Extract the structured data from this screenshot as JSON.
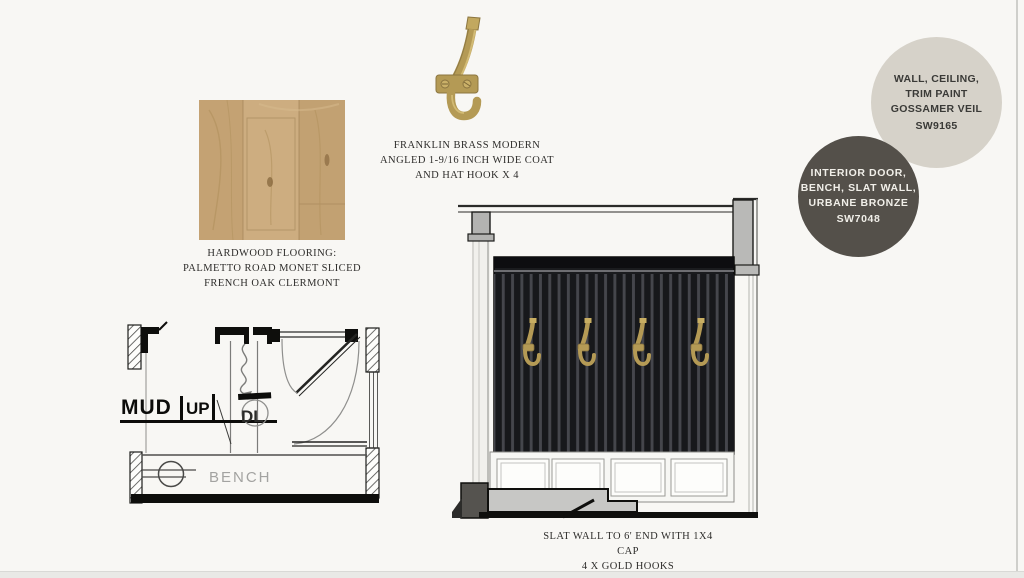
{
  "page": {
    "background": "#f8f7f4"
  },
  "flooring": {
    "caption": [
      "HARDWOOD FLOORING:",
      "PALMETTO ROAD MONET SLICED",
      "FRENCH OAK CLERMONT"
    ],
    "wood_color": "#c9a97b"
  },
  "coat_hook": {
    "caption": [
      "FRANKLIN BRASS MODERN",
      "ANGLED 1-9/16 INCH WIDE COAT",
      "AND HAT HOOK X 4"
    ],
    "brass_color": "#b49a55"
  },
  "paint_swatches": [
    {
      "name": "gossamer-veil",
      "lines": [
        "WALL, CEILING,",
        "TRIM PAINT",
        "GOSSAMER VEIL",
        "SW9165"
      ],
      "color": "#d6d2c9",
      "text_color": "#3a3a37"
    },
    {
      "name": "urbane-bronze",
      "lines": [
        "INTERIOR DOOR,",
        "BENCH, SLAT WALL,",
        "URBANE BRONZE",
        "SW7048"
      ],
      "color": "#54504a",
      "text_color": "#f1efe9"
    }
  ],
  "floor_plan": {
    "labels": {
      "room": "MUD",
      "stair": "UP",
      "tag": "DL",
      "bench": "BENCH"
    }
  },
  "elevation": {
    "caption": [
      "SLAT WALL TO 6' END WITH 1X4",
      "CAP",
      "4 X GOLD HOOKS"
    ],
    "hook_count": 4,
    "slat_color": "#1a1b1e"
  }
}
